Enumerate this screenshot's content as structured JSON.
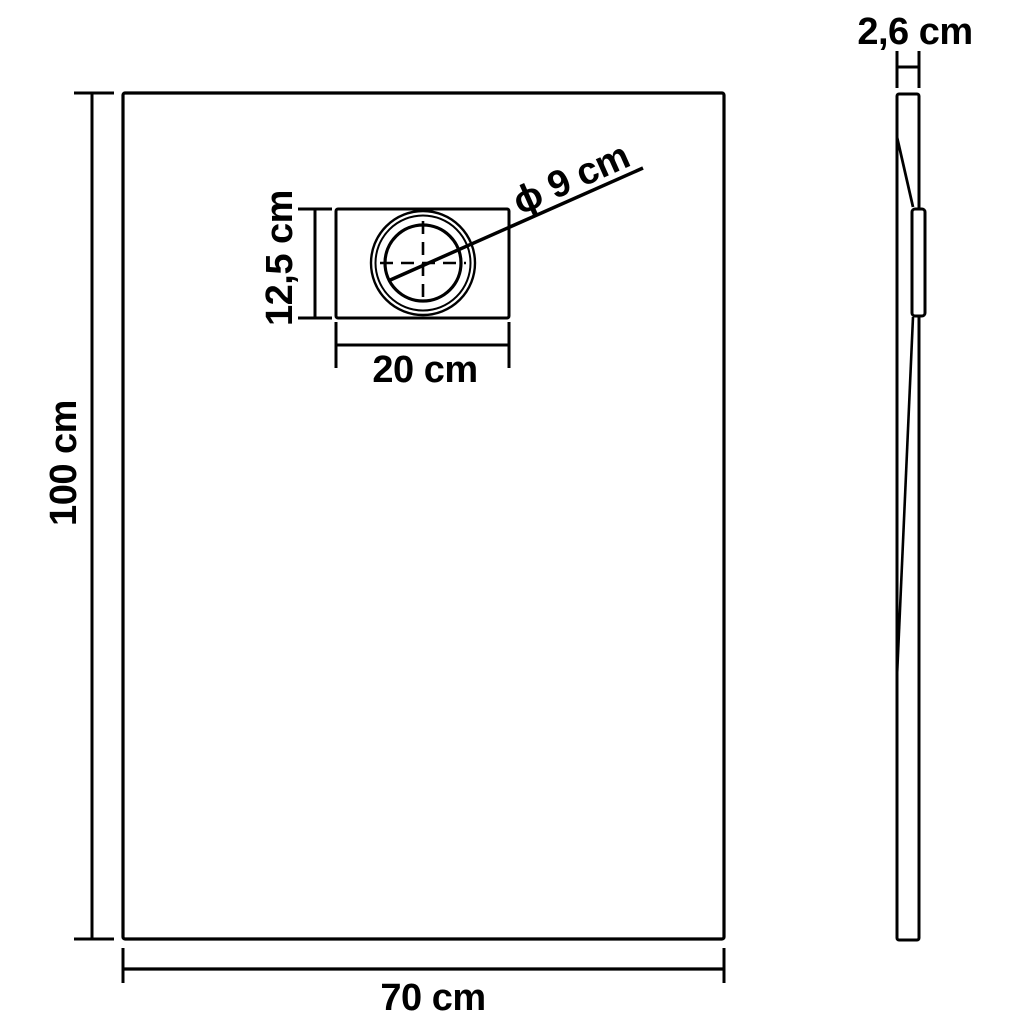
{
  "page": {
    "background_color": "#ffffff",
    "line_color": "#000000",
    "text_color": "#000000"
  },
  "front_view": {
    "height_label": "100 cm",
    "width_label": "70 cm",
    "drain": {
      "width_label": "20 cm",
      "height_label": "12,5 cm",
      "diameter_label": "ϕ 9 cm"
    }
  },
  "side_view": {
    "thickness_label": "2,6 cm"
  }
}
